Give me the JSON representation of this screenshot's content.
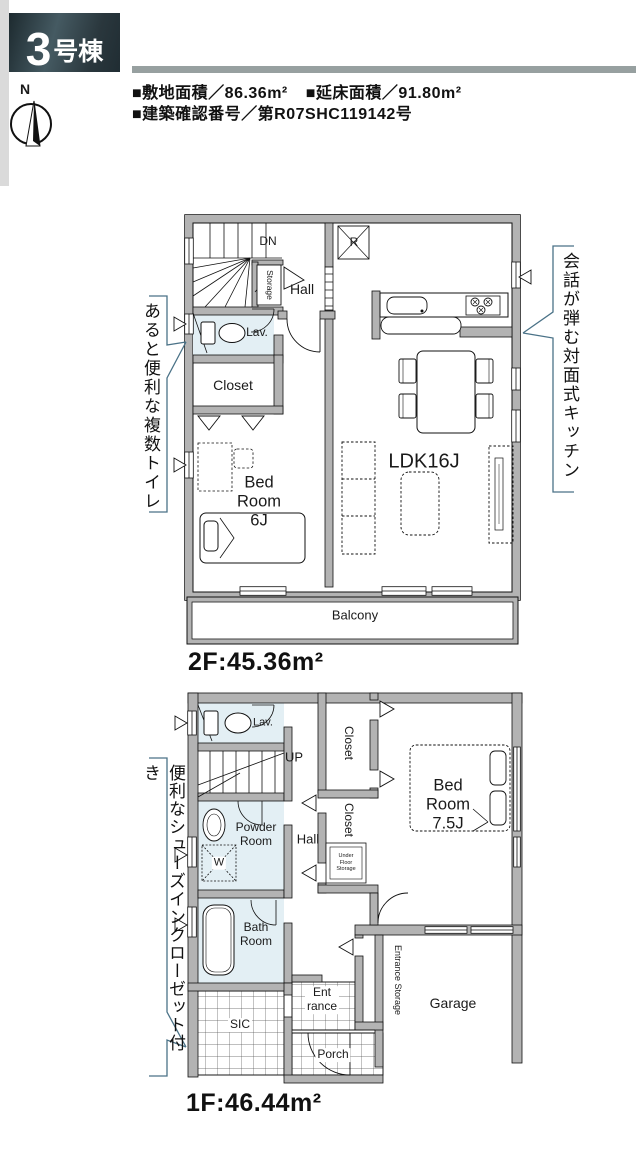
{
  "header": {
    "badge": {
      "number": "3",
      "suffix": "号棟"
    },
    "info_line1_left": "■敷地面積／86.36m²",
    "info_line1_right": "■延床面積／91.80m²",
    "info_line2": "■建築確認番号／第R07SHC119142号",
    "compass": {
      "north_label": "N"
    }
  },
  "floor2": {
    "area_label": "2F:45.36m²",
    "rooms": {
      "stairs": "DN",
      "storage": "Storage",
      "hall": "Hall",
      "lavatory": "Lav.",
      "closet": "Closet",
      "bedroom": "Bed Room 6J",
      "refrigerator": "R",
      "ldk": "LDK16J",
      "balcony": "Balcony"
    }
  },
  "floor1": {
    "area_label": "1F:46.44m²",
    "rooms": {
      "lavatory": "Lav.",
      "stairs": "UP",
      "closet_upper": "Closet",
      "closet_lower": "Closet",
      "under_floor_storage": "Under Floor Storage",
      "bedroom": "Bed Room 7.5J",
      "powder_room": "Powder Room",
      "hall": "Hall",
      "washer": "W",
      "bath_room": "Bath Room",
      "entrance_storage": "Entrance Storage",
      "garage": "Garage",
      "sic": "SIC",
      "entrance": "Ent\nrance",
      "porch": "Porch"
    }
  },
  "captions": {
    "multiple_toilets": "あると便利な複数トイレ",
    "kitchen": "会話が弾む対面式キッチン",
    "shoes_closet": "便利なシューズインクローゼット付き"
  },
  "colors": {
    "wall": "#b3b3b3",
    "wet_room": "#e3eff4",
    "accent_line": "#4a7287",
    "badge_bg": "#2c3a40"
  }
}
